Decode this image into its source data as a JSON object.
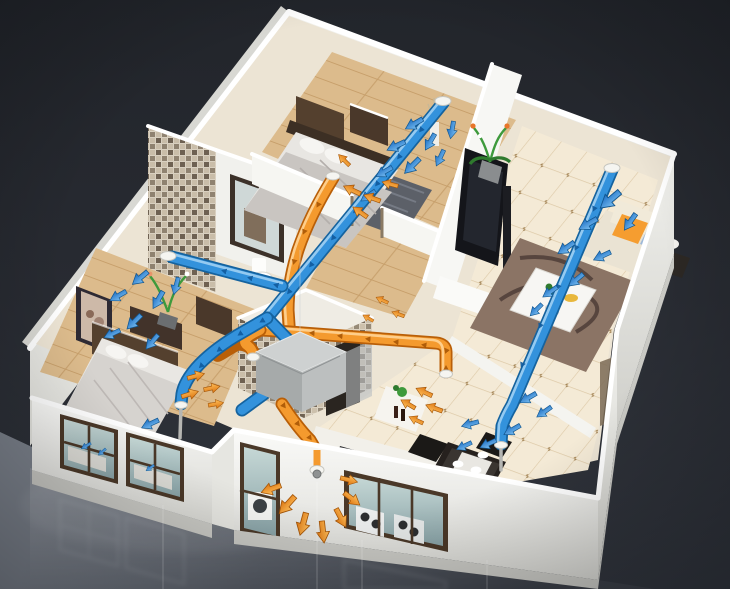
{
  "scene": {
    "kind": "3d-cutaway-apartment-ventilation-rendering",
    "rooms": [
      "master-bedroom",
      "living-room",
      "second-bedroom",
      "bathroom",
      "interior-bathroom",
      "kitchen-dining",
      "hallway"
    ],
    "airflow": {
      "supply_color": "#3392dc",
      "exhaust_color": "#f49a2e",
      "ceiling_diffusers": 3,
      "floor_supply_stands": 2,
      "exhaust_drops": 3,
      "exterior_exhaust_outlet": 1,
      "ventilation_units": 1
    }
  },
  "colors": {
    "bg_top": "#22252b",
    "bg_mid": "#282b32",
    "bg_bottom": "#31353d",
    "shine_hi": "#7b818b",
    "shine_mid": "#565b64",
    "shine_lo": "#3a3e46",
    "wall_hi": "#fafaf8",
    "wall_lo": "#d9d9d4",
    "wall_inner": "#f3f3ef",
    "slab": "#c9c9c4",
    "wood_hi": "#dcbb8c",
    "wood_line": "#c79f6b",
    "tile": "#f4ead6",
    "tile_line": "#ddc9a7",
    "tile_dot": "#a5875a",
    "glass_hi": "#c6d8d6",
    "glass_lo": "#87a1a5",
    "window_frame": "#4a3828",
    "duct_blue": "#3392dc",
    "duct_blue_dk": "#15639f",
    "duct_blue_hi": "#a6d4f4",
    "duct_orange": "#f49a2e",
    "duct_orange_dk": "#b95f08",
    "duct_orange_hi": "#ffd79b",
    "hrv_top": "#ced1d1",
    "hrv_left": "#a6aaaa",
    "hrv_right": "#bcbfbf",
    "rug_brown": "#8b7465",
    "rug_gray": "#5c6068",
    "sofa": "#eae3d3",
    "cushion_orange": "#f59d30",
    "plant_green": "#3e9a3c",
    "dark_furniture": "#26211e",
    "wood_furniture": "#54402e",
    "mosaic_a": "#c9bda9",
    "mosaic_b": "#8f8270",
    "mosaic_c": "#6e6152",
    "mosaic_d": "#d9d0c0",
    "base_floor": "#ece4d4"
  }
}
